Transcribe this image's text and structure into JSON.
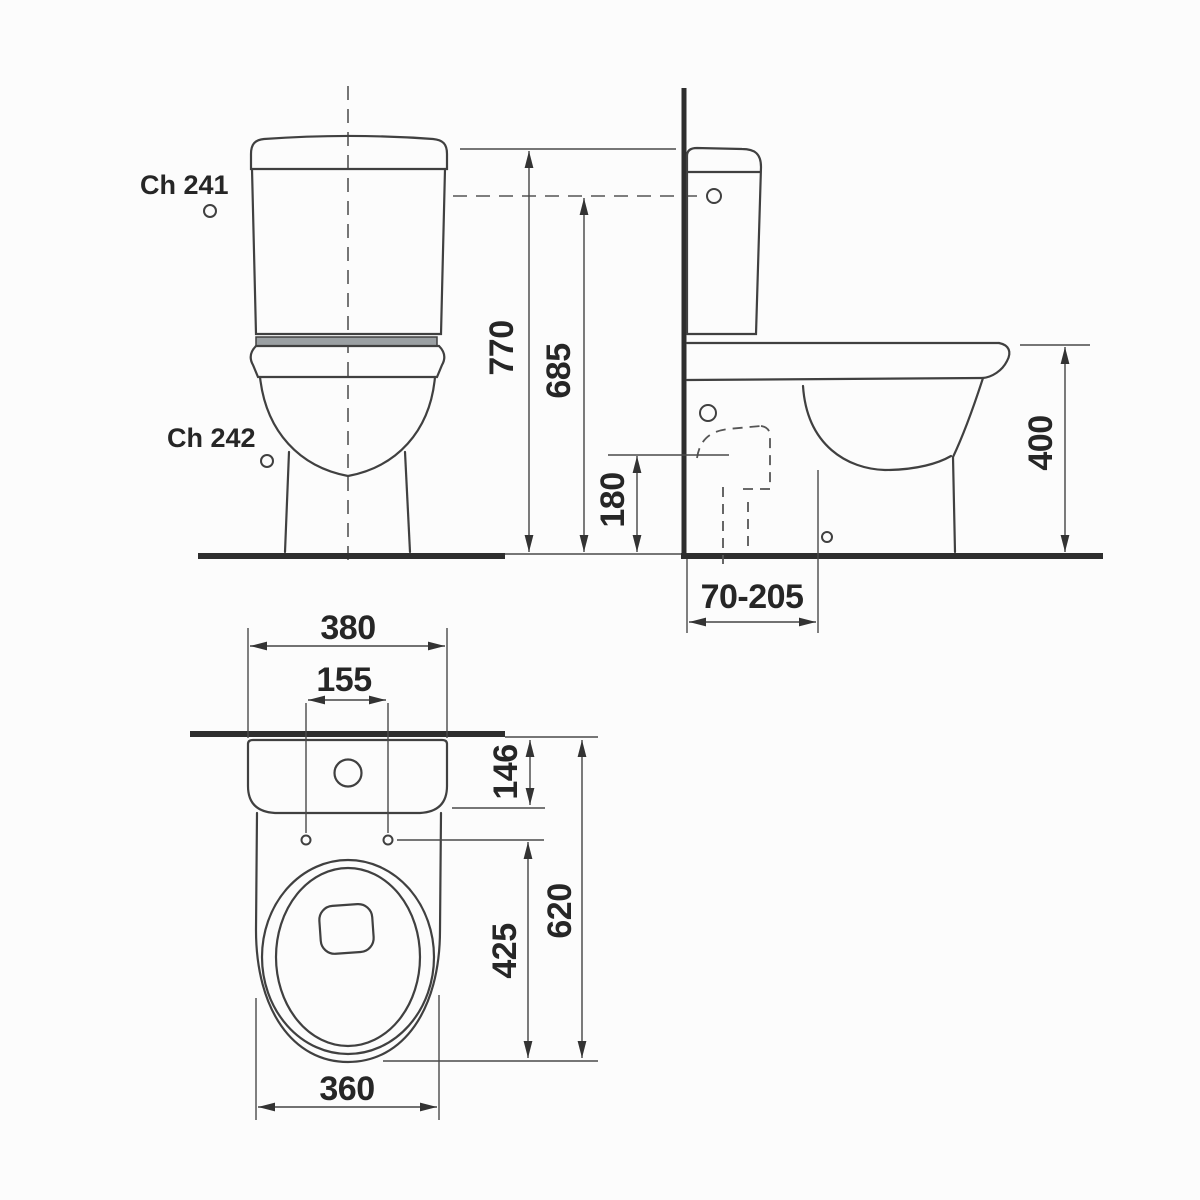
{
  "product_labels": {
    "top": "Ch 241",
    "bottom": "Ch 242"
  },
  "dims": {
    "front_total_height": "770",
    "front_tank_height": "685",
    "side_inlet_height": "180",
    "side_bowl_height": "400",
    "side_outlet_offset": "70-205",
    "plan_tank_width": "380",
    "plan_hole_spacing": "155",
    "plan_tank_depth": "146",
    "plan_total_depth": "620",
    "plan_holes_to_front": "425",
    "plan_bowl_width": "360"
  },
  "colors": {
    "line": "#404040",
    "thick_line": "#2e2e2e",
    "text": "#262626",
    "hinge_band": "#9ba0a3",
    "background": "#fcfcfc"
  }
}
